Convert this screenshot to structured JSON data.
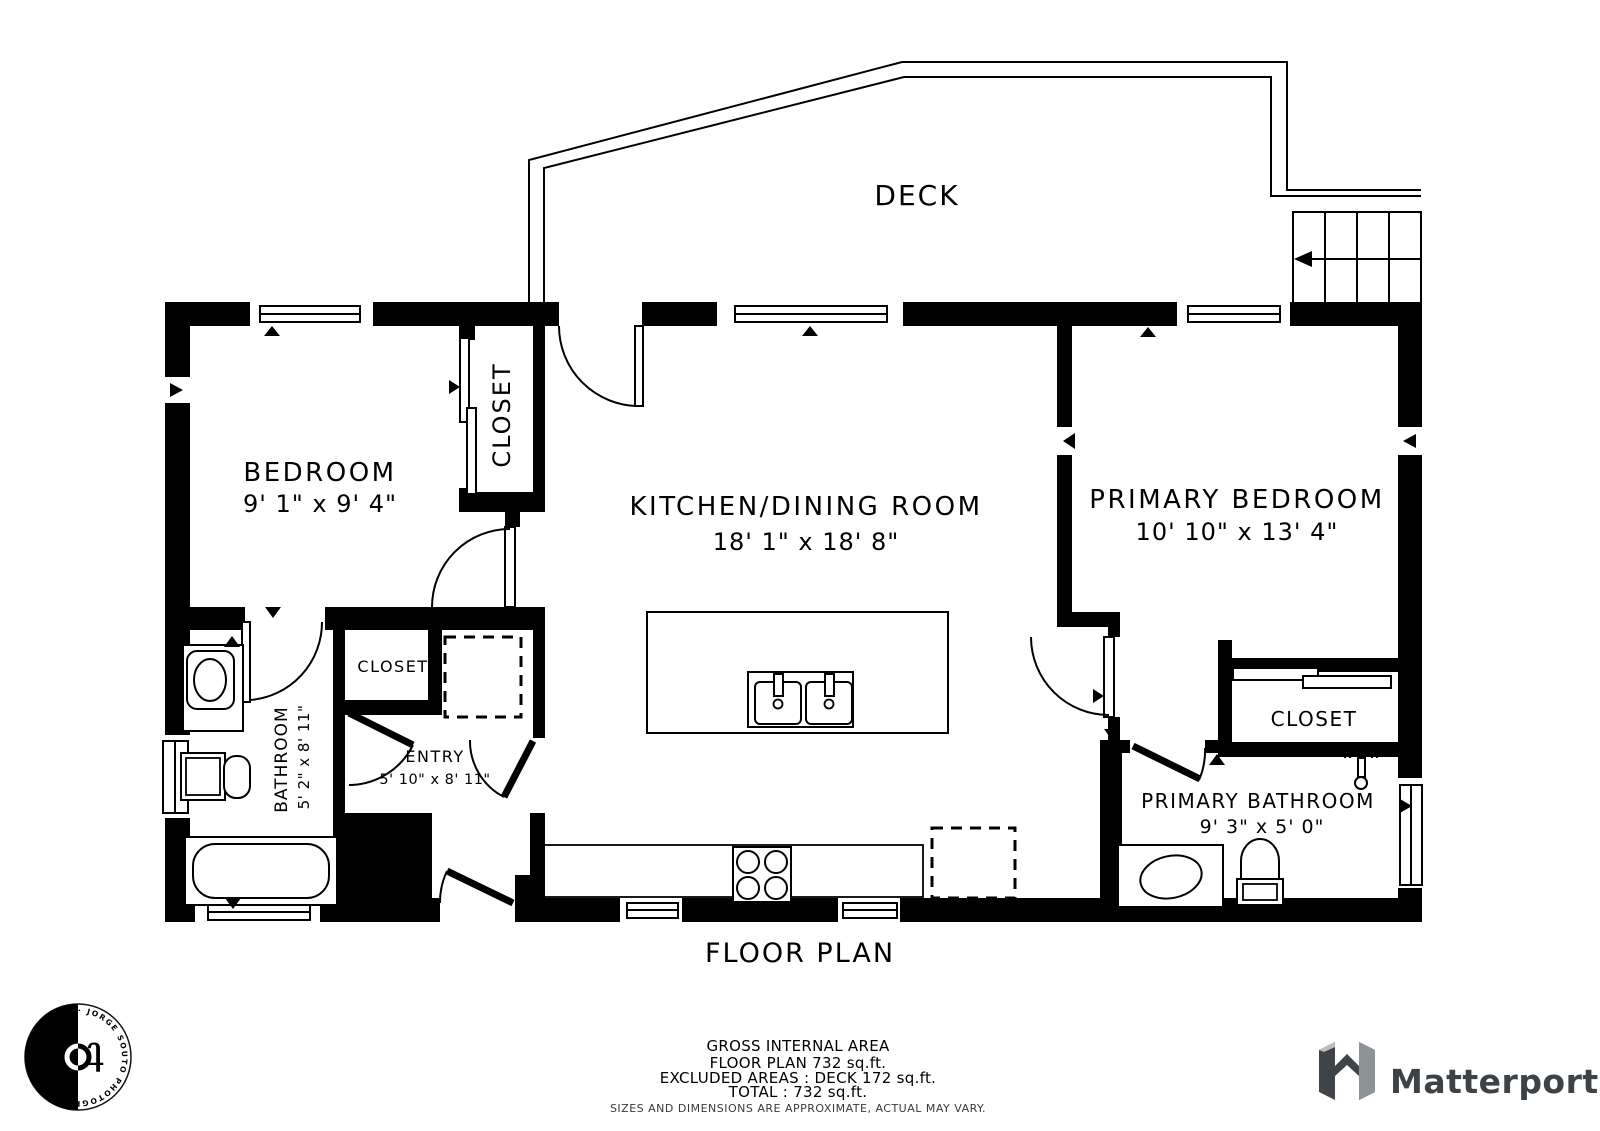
{
  "title": "FLOOR PLAN",
  "deck": {
    "label": "DECK"
  },
  "rooms": {
    "bedroom": {
      "name": "BEDROOM",
      "dims": "9' 1\" x 9' 4\""
    },
    "bedroom_closet": {
      "name": "CLOSET"
    },
    "kitchen": {
      "name": "KITCHEN/DINING ROOM",
      "dims": "18' 1\" x 18' 8\""
    },
    "primary_bedroom": {
      "name": "PRIMARY BEDROOM",
      "dims": "10' 10\" x 13' 4\""
    },
    "bathroom": {
      "name": "BATHROOM",
      "dims": "5' 2\" x 8' 11\""
    },
    "entry": {
      "name": "ENTRY",
      "dims": "5' 10\" x 8' 11\""
    },
    "entry_closet": {
      "name": "CLOSET"
    },
    "primary_bathroom": {
      "name": "PRIMARY BATHROOM",
      "dims": "9' 3\" x 5' 0\""
    },
    "primary_closet": {
      "name": "CLOSET"
    }
  },
  "footer": {
    "area_title": "GROSS INTERNAL AREA",
    "floor_plan_area": "FLOOR PLAN 732 sq.ft.",
    "excluded": "EXCLUDED AREAS :  DECK 172 sq.ft.",
    "total": "TOTAL :  732 sq.ft.",
    "disclaimer": "SIZES AND DIMENSIONS ARE APPROXIMATE, ACTUAL MAY VARY."
  },
  "branding": {
    "matterport": "Matterport",
    "photographer": "· JORGE SOUTO PHOTOGRAPHY · JORGE SOUTO PHOTOGRAPHY "
  },
  "colors": {
    "wall": "#000000",
    "background": "#ffffff",
    "matterport_text": "#3d4247",
    "matterport_icon_dark": "#3f4448",
    "matterport_icon_light": "#8e9396",
    "disclaimer_text": "#3a3a3a"
  }
}
